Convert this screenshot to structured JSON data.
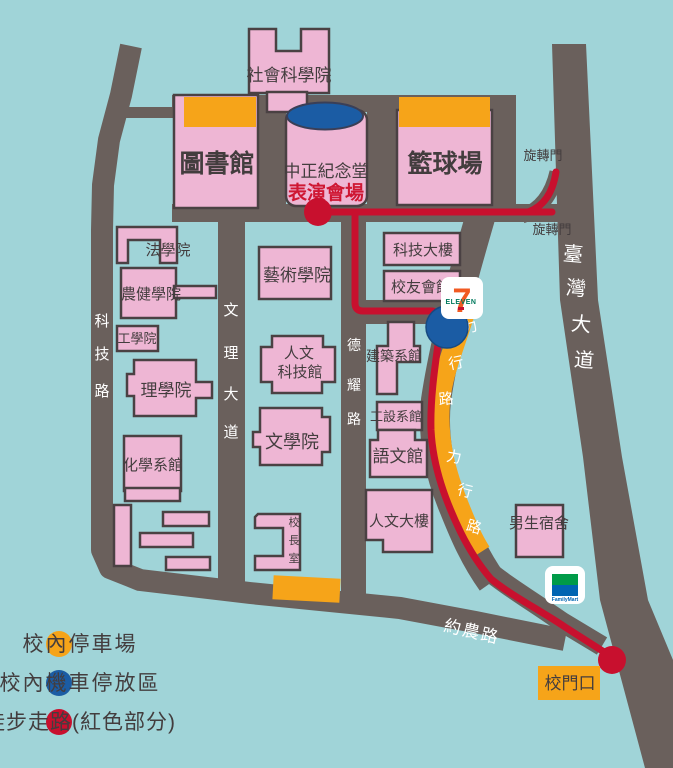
{
  "map_title": "campus-walking-map",
  "buildings": {
    "social_science": "社會科學院",
    "library": "圖書館",
    "cks_hall": "中正紀念堂",
    "performance_venue": "表演會場",
    "basketball_court": "籃球場",
    "law": "法學院",
    "agri_health": "農健學院",
    "engineering": "工學院",
    "science": "理學院",
    "chemistry": "化學系館",
    "arts": "藝術學院",
    "humanities_tech": [
      "人文",
      "科技館"
    ],
    "literature": "文學院",
    "tech_building": "科技大樓",
    "alumni_house": "校友會館",
    "architecture": "建築系館",
    "industrial_design": "工設系館",
    "language_hall": "語文館",
    "humanities_building": "人文大樓",
    "male_dorm": "男生宿舍",
    "principal_office": [
      "校",
      "長",
      "室"
    ],
    "school_gate": "校門口"
  },
  "roads": {
    "keji_road": [
      "科",
      "技",
      "路"
    ],
    "wenli_blvd": [
      "文",
      "理",
      "大",
      "道"
    ],
    "deyao_road": [
      "德",
      "耀",
      "路"
    ],
    "taiwan_blvd": [
      "臺",
      "灣",
      "大",
      "道"
    ],
    "lixing_road": [
      "力",
      "行",
      "路"
    ],
    "yuenong_road": "約農路"
  },
  "gates": {
    "revolving_door": "旋轉門"
  },
  "stores": {
    "seven_eleven": {
      "seven": "7",
      "eleven": "ELEVEN"
    },
    "family_mart": {
      "name": "FamilyMart"
    }
  },
  "legend": {
    "items": [
      {
        "label": "校內停車場",
        "color": "#f6a419"
      },
      {
        "label": "校內機車停放區",
        "color": "#1b5ca4"
      },
      {
        "label": "徒步走路(紅色部分)",
        "color": "#c8102e"
      }
    ]
  },
  "colors": {
    "background": "#a0d4d8",
    "road": "#6a605c",
    "building_pink": "#eeb6d4",
    "parking_orange": "#f6a419",
    "scooter_blue": "#1b5ca4",
    "walk_red": "#c8102e"
  }
}
